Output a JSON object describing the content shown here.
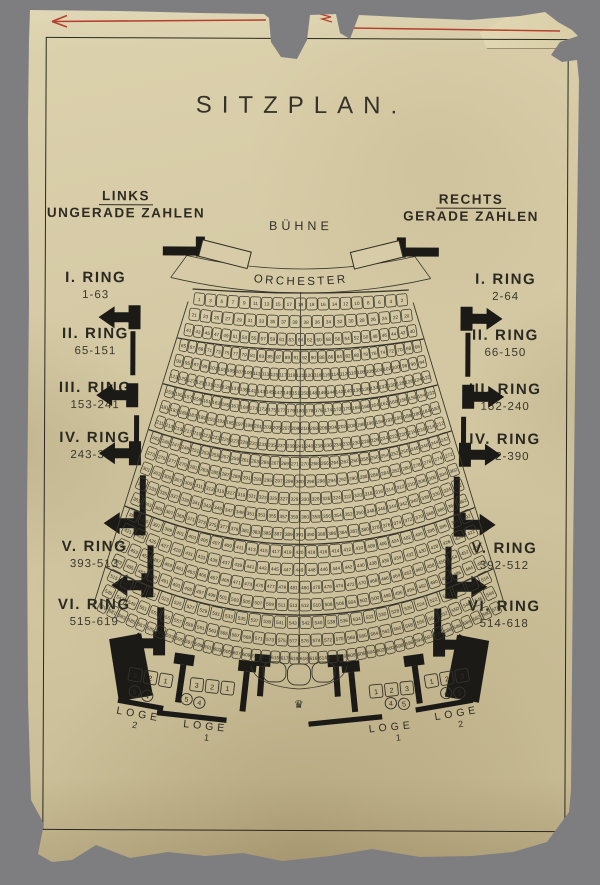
{
  "title": "SITZPLAN.",
  "header_left": {
    "title": "LINKS",
    "subtitle": "UNGERADE ZAHLEN"
  },
  "header_right": {
    "title": "RECHTS",
    "subtitle": "GERADE ZAHLEN"
  },
  "stage": {
    "label": "BÜHNE"
  },
  "orchestra": {
    "label": "ORCHESTER"
  },
  "rings_left": [
    {
      "name": "I. RING",
      "range": "1-63"
    },
    {
      "name": "II. RING",
      "range": "65-151"
    },
    {
      "name": "III. RING",
      "range": "153-241"
    },
    {
      "name": "IV. RING",
      "range": "243-391"
    },
    {
      "name": "V. RING",
      "range": "393-513"
    },
    {
      "name": "VI. RING",
      "range": "515-619"
    }
  ],
  "rings_right": [
    {
      "name": "I. RING",
      "range": "2-64"
    },
    {
      "name": "II. RING",
      "range": "66-150"
    },
    {
      "name": "III. RING",
      "range": "152-240"
    },
    {
      "name": "IV. RING",
      "range": "242-390"
    },
    {
      "name": "V. RING",
      "range": "392-512"
    },
    {
      "name": "VI. RING",
      "range": "514-618"
    }
  ],
  "seat_rows": [
    {
      "start": 1,
      "end": 19
    },
    {
      "start": 20,
      "end": 39
    },
    {
      "start": 40,
      "end": 64
    },
    {
      "start": 65,
      "end": 92
    },
    {
      "start": 93,
      "end": 121
    },
    {
      "start": 122,
      "end": 151
    },
    {
      "start": 152,
      "end": 180
    },
    {
      "start": 181,
      "end": 210
    },
    {
      "start": 211,
      "end": 241
    },
    {
      "start": 242,
      "end": 271
    },
    {
      "start": 272,
      "end": 300
    },
    {
      "start": 301,
      "end": 330
    },
    {
      "start": 331,
      "end": 360
    },
    {
      "start": 361,
      "end": 391
    },
    {
      "start": 392,
      "end": 420
    },
    {
      "start": 421,
      "end": 449
    },
    {
      "start": 450,
      "end": 481
    },
    {
      "start": 482,
      "end": 513
    },
    {
      "start": 514,
      "end": 543
    },
    {
      "start": 544,
      "end": 577
    },
    {
      "start": 578,
      "end": 619
    }
  ],
  "ring_row_counts": [
    3,
    3,
    3,
    5,
    4,
    3
  ],
  "loges": {
    "left": [
      {
        "label": "LOGE",
        "number": "2",
        "chairs": [
          "3",
          "2",
          "1"
        ],
        "stools": [
          "5",
          "4"
        ]
      },
      {
        "label": "LOGE",
        "number": "1",
        "chairs": [
          "3",
          "2",
          "1"
        ],
        "stools": [
          "5",
          "4"
        ]
      }
    ],
    "right": [
      {
        "label": "LOGE",
        "number": "1",
        "chairs": [
          "1",
          "2",
          "3"
        ],
        "stools": [
          "4",
          "5"
        ]
      },
      {
        "label": "LOGE",
        "number": "2",
        "chairs": [
          "1",
          "2",
          "3"
        ],
        "stools": [
          "4",
          "5"
        ]
      }
    ]
  },
  "ornament_crown": "♛",
  "colors": {
    "paper": "#d4c9a5",
    "ink": "#2b2920",
    "red_pencil": "#b5402e",
    "background": "#7e7e81"
  }
}
